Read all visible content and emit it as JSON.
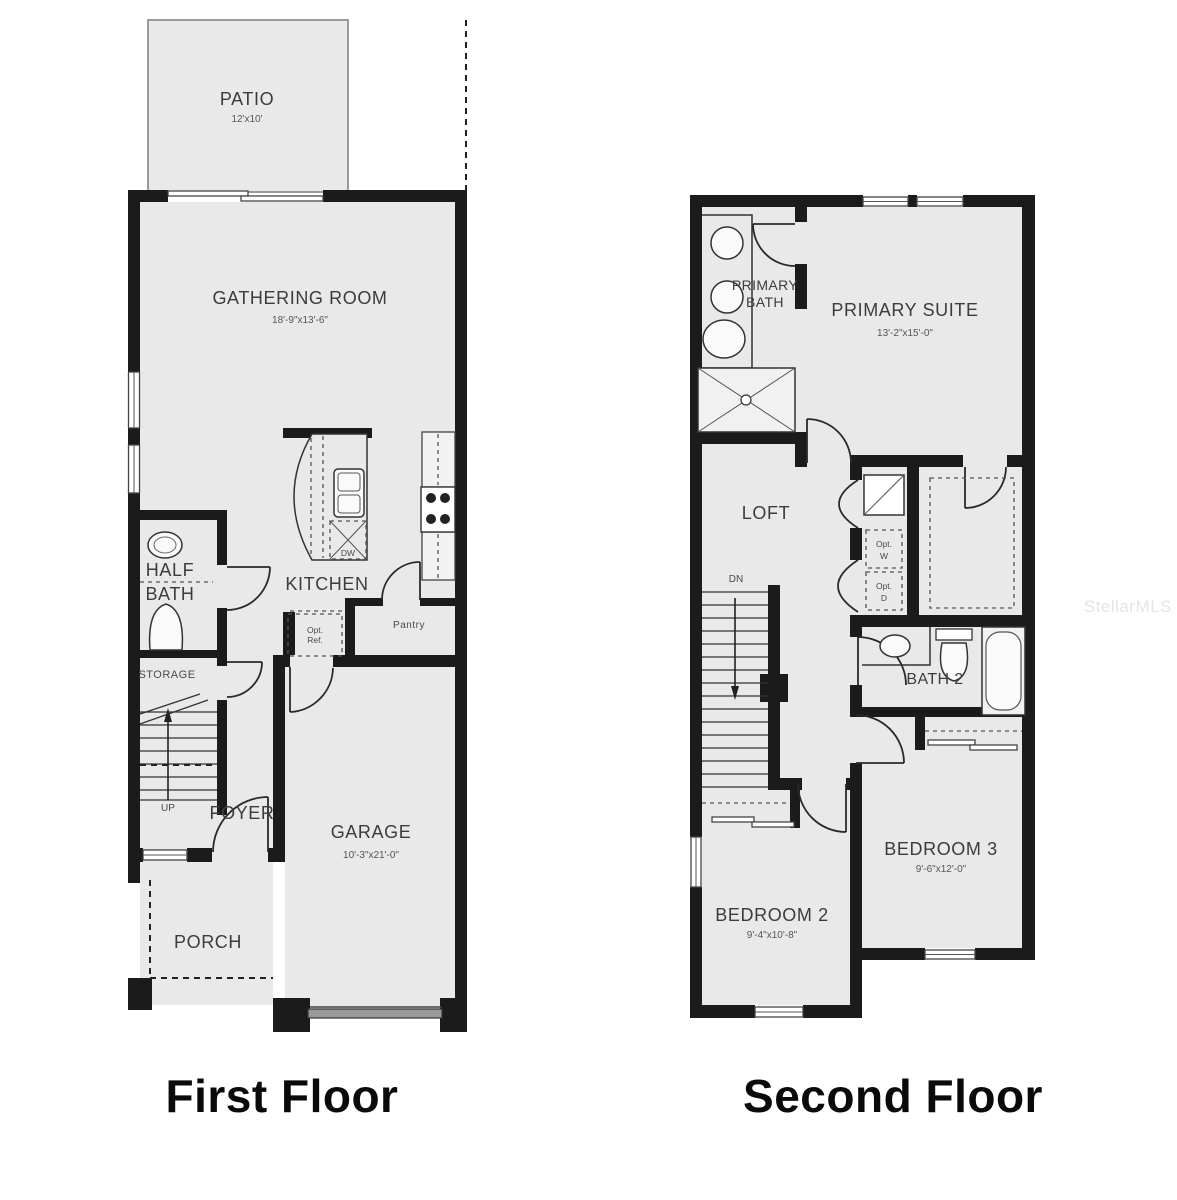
{
  "watermark": "StellarMLS",
  "colors": {
    "floor_fill": "#e9e9e9",
    "wall": "#1b1b1b",
    "label": "#3c3c3c"
  },
  "first": {
    "title": "First Floor",
    "patio_name": "PATIO",
    "patio_dims": "12'x10'",
    "gathering_name": "GATHERING ROOM",
    "gathering_dims": "18'-9\"x13'-6\"",
    "kitchen_name": "KITCHEN",
    "half_bath_line1": "HALF",
    "half_bath_line2": "BATH",
    "storage_name": "STORAGE",
    "up_label": "UP",
    "foyer_name": "FOYER",
    "porch_name": "PORCH",
    "garage_name": "GARAGE",
    "garage_dims": "10'-3\"x21'-0\"",
    "opt_ref_line1": "Opt.",
    "opt_ref_line2": "Ref.",
    "pantry_name": "Pantry",
    "dw_label": "DW"
  },
  "second": {
    "title": "Second Floor",
    "primary_bath_line1": "PRIMARY",
    "primary_bath_line2": "BATH",
    "primary_suite_name": "PRIMARY SUITE",
    "primary_suite_dims": "13'-2\"x15'-0\"",
    "loft_name": "LOFT",
    "dn_label": "DN",
    "opt_w_line1": "Opt.",
    "opt_w_line2": "W",
    "opt_d_line1": "Opt.",
    "opt_d_line2": "D",
    "bath2_name": "BATH 2",
    "bedroom2_name": "BEDROOM 2",
    "bedroom2_dims": "9'-4\"x10'-8\"",
    "bedroom3_name": "BEDROOM 3",
    "bedroom3_dims": "9'-6\"x12'-0\""
  }
}
